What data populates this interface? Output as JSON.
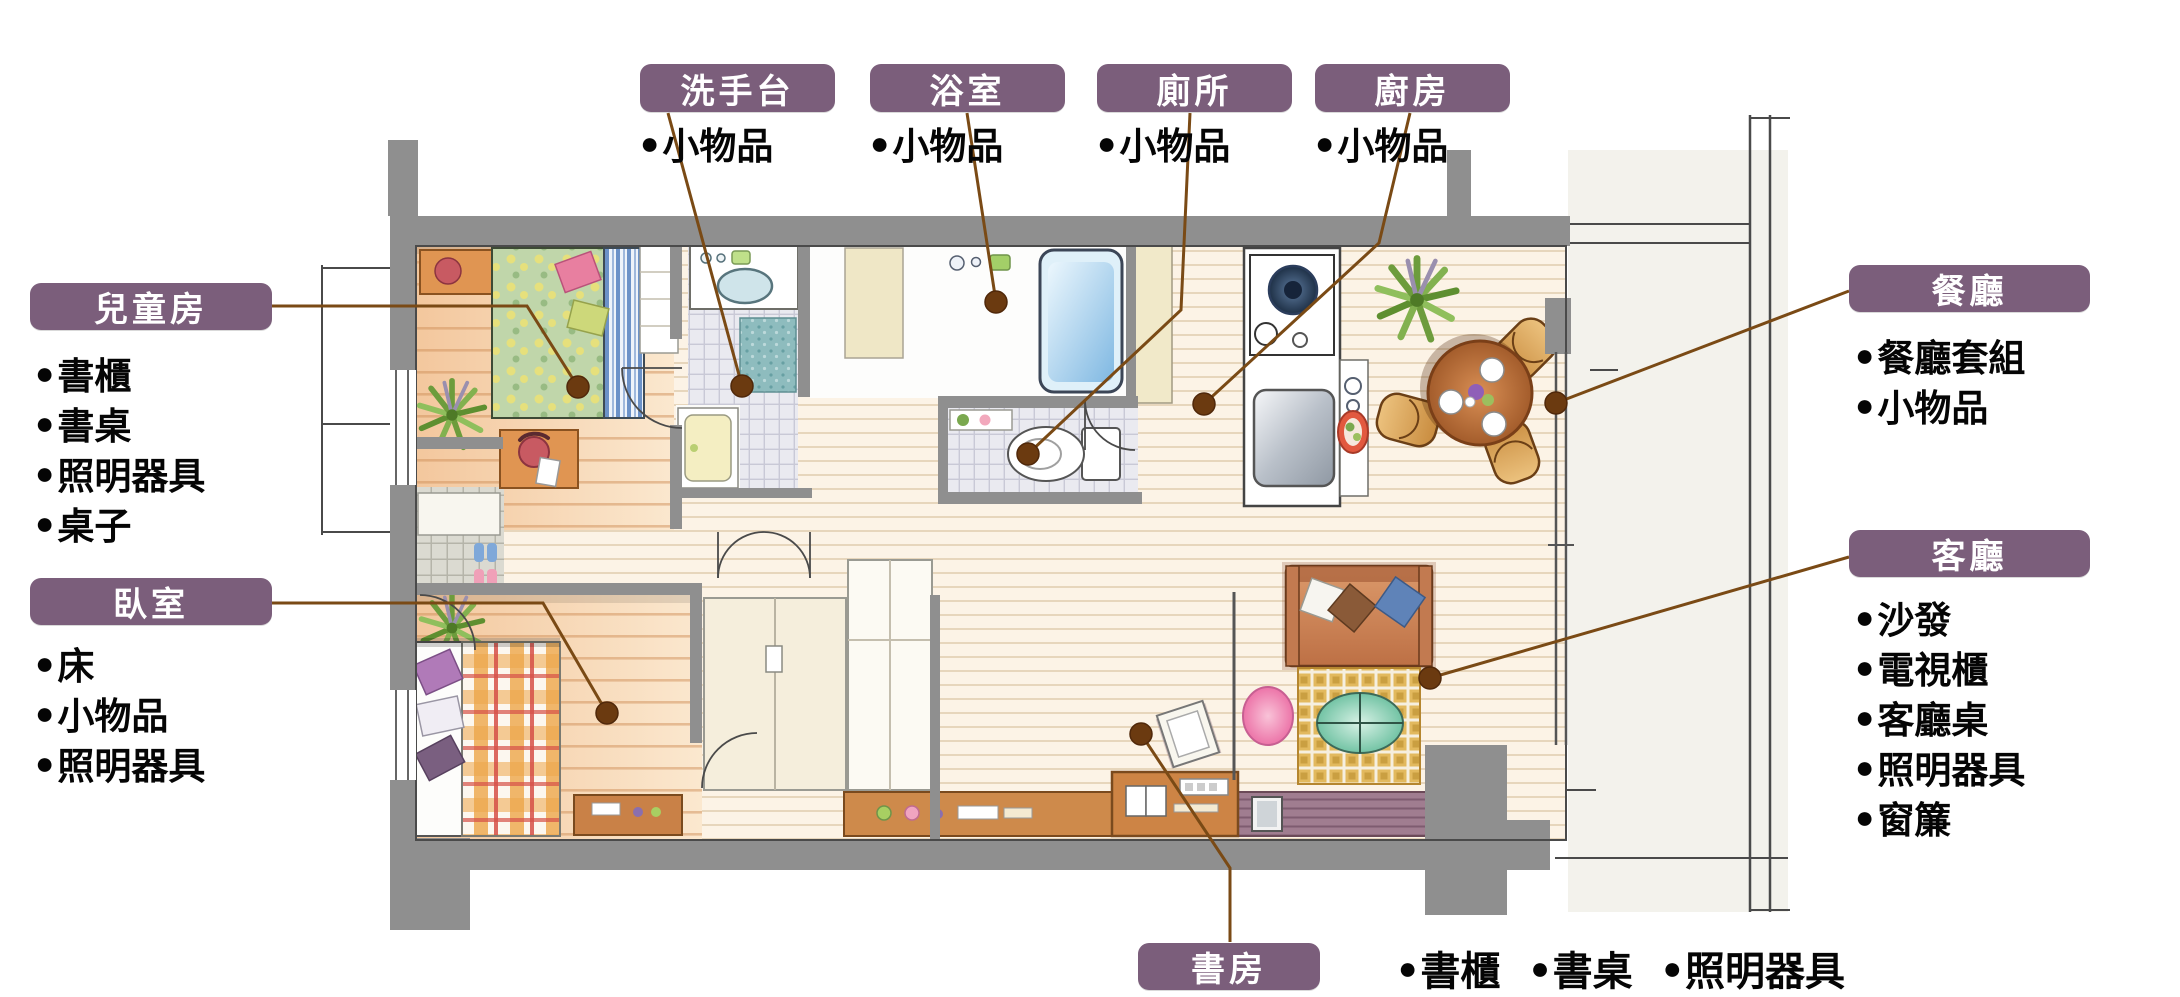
{
  "bullet": "●",
  "palette": {
    "label_bg": "#7b5e7b",
    "label_text": "#ffffff",
    "callout_line": "#7a4a15",
    "callout_dot": "#6b3a10",
    "wall_gray": "#8f8f8f",
    "list_text": "#050505"
  },
  "callouts": {
    "washbasin": {
      "label": "洗手台",
      "items": [
        "小物品"
      ]
    },
    "bathroom": {
      "label": "浴室",
      "items": [
        "小物品"
      ]
    },
    "toilet": {
      "label": "廁所",
      "items": [
        "小物品"
      ]
    },
    "kitchen": {
      "label": "廚房",
      "items": [
        "小物品"
      ]
    },
    "kids_room": {
      "label": "兒童房",
      "items": [
        "書櫃",
        "書桌",
        "照明器具",
        "桌子"
      ]
    },
    "bedroom": {
      "label": "臥室",
      "items": [
        "床",
        "小物品",
        "照明器具"
      ]
    },
    "dining": {
      "label": "餐廳",
      "items": [
        "餐廳套組",
        "小物品"
      ]
    },
    "living": {
      "label": "客廳",
      "items": [
        "沙發",
        "電視櫃",
        "客廳桌",
        "照明器具",
        "窗簾"
      ]
    },
    "study": {
      "label": "書房",
      "items": [
        "書櫃",
        "書桌",
        "照明器具"
      ]
    }
  }
}
